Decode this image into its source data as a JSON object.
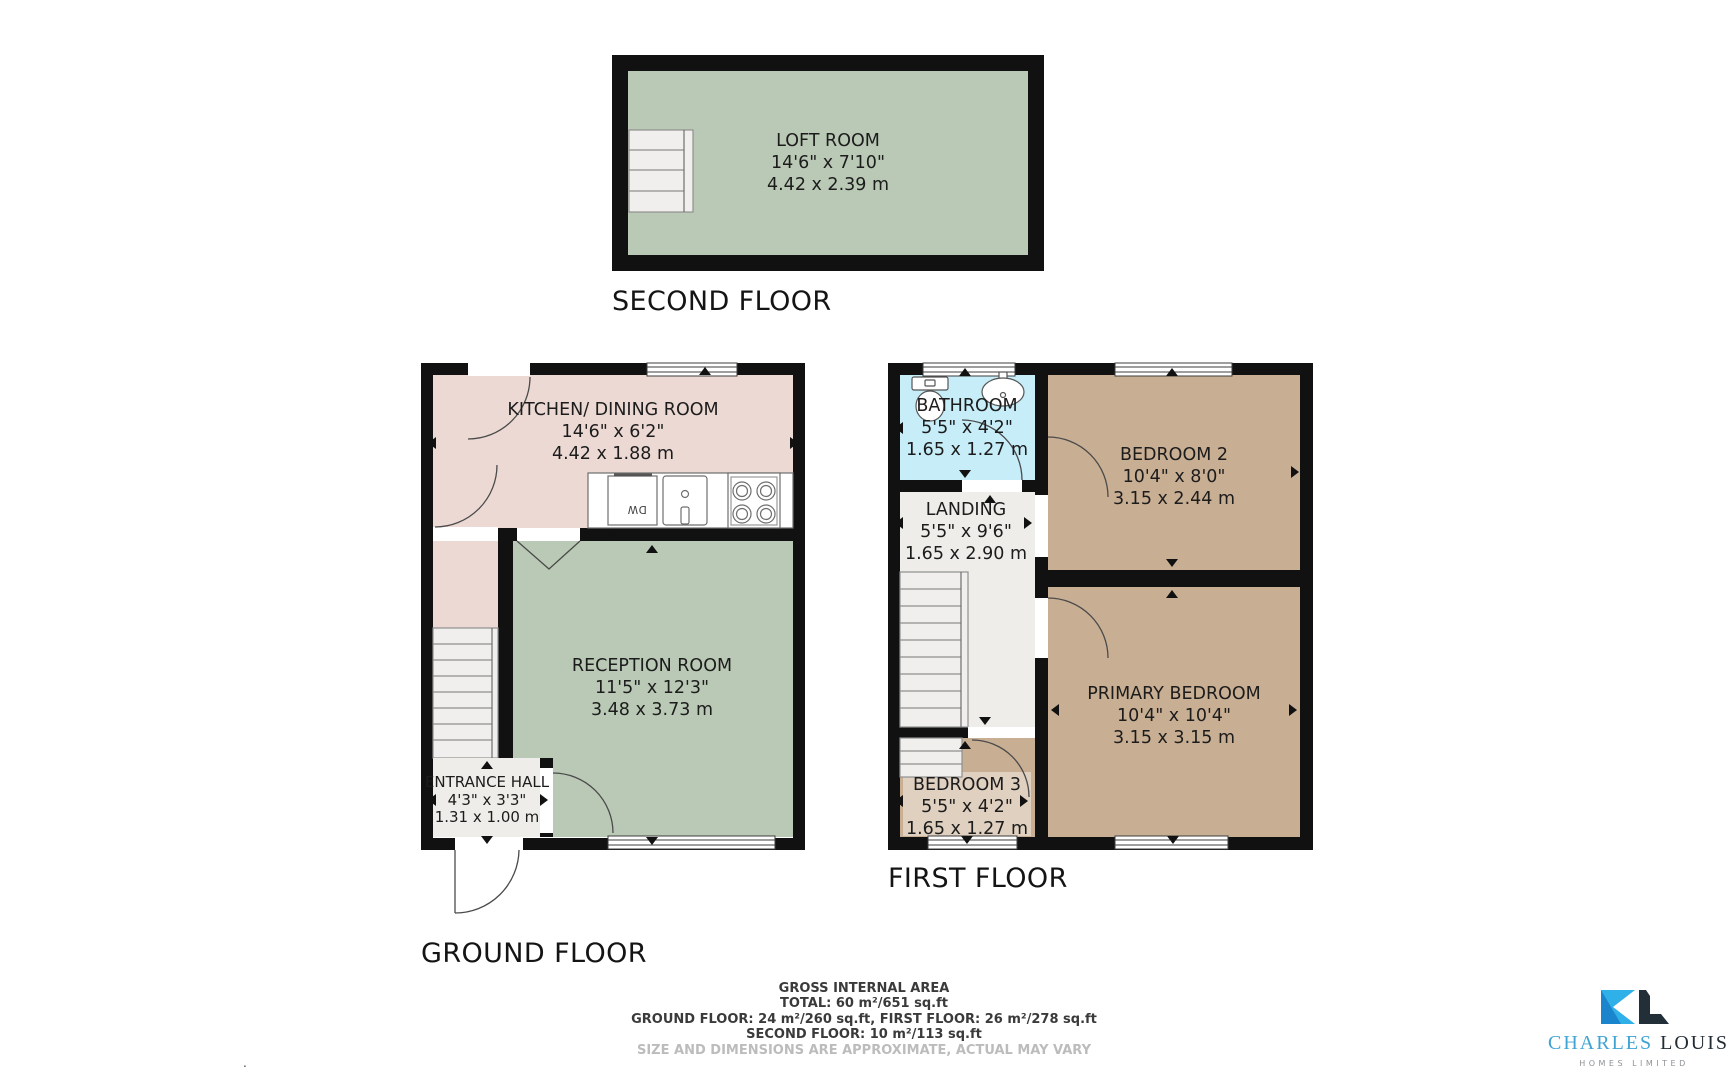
{
  "floors": [
    {
      "label": "SECOND FLOOR",
      "rooms": [
        {
          "name": "LOFT ROOM",
          "imperial": "14'6\" x 7'10\"",
          "metric": "4.42 x 2.39 m"
        }
      ]
    },
    {
      "label": "GROUND FLOOR",
      "rooms": [
        {
          "name": "KITCHEN/ DINING ROOM",
          "imperial": "14'6\" x 6'2\"",
          "metric": "4.42 x 1.88 m"
        },
        {
          "name": "RECEPTION ROOM",
          "imperial": "11'5\" x 12'3\"",
          "metric": "3.48 x 3.73 m"
        },
        {
          "name": "ENTRANCE HALL",
          "imperial": "4'3\" x 3'3\"",
          "metric": "1.31 x 1.00 m"
        }
      ]
    },
    {
      "label": "FIRST FLOOR",
      "rooms": [
        {
          "name": "BATHROOM",
          "imperial": "5'5\" x 4'2\"",
          "metric": "1.65 x 1.27 m"
        },
        {
          "name": "LANDING",
          "imperial": "5'5\" x 9'6\"",
          "metric": "1.65 x 2.90 m"
        },
        {
          "name": "BEDROOM 2",
          "imperial": "10'4\" x 8'0\"",
          "metric": "3.15 x 2.44 m"
        },
        {
          "name": "PRIMARY BEDROOM",
          "imperial": "10'4\" x 10'4\"",
          "metric": "3.15 x 3.15 m"
        },
        {
          "name": "BEDROOM 3",
          "imperial": "5'5\" x 4'2\"",
          "metric": "1.65 x 1.27 m"
        }
      ]
    }
  ],
  "appliances": {
    "dishwasher": "DW"
  },
  "footer": {
    "line1": "GROSS INTERNAL AREA",
    "line2": "TOTAL: 60 m²/651 sq.ft",
    "line3": "GROUND FLOOR: 24 m²/260 sq.ft, FIRST FLOOR: 26 m²/278 sq.ft",
    "line4": "SECOND FLOOR: 10 m²/113 sq.ft",
    "disclaimer": "SIZE AND DIMENSIONS ARE APPROXIMATE, ACTUAL MAY VARY"
  },
  "logo": {
    "name_primary": "CHARLES",
    "name_secondary": "LOUIS",
    "tagline": "HOMES LIMITED"
  },
  "misc": {
    "dot": "."
  },
  "colors": {
    "wall": "#111111",
    "loft_green": "#bac9b5",
    "kitchen_pink": "#ecd9d3",
    "reception_green": "#bac9b5",
    "bedroom_tan": "#c8ae93",
    "bathroom_blue": "#c7edf8",
    "hall_gray": "#eeede9",
    "stair_gray": "#f0efed",
    "logo_cyan": "#2fb0e8",
    "logo_blue": "#1a85cc",
    "logo_navy": "#222e38",
    "logo_text_blue": "#3fa3d4",
    "logo_text_dark": "#222c35",
    "disclaimer_gray": "#bcbcbc"
  }
}
